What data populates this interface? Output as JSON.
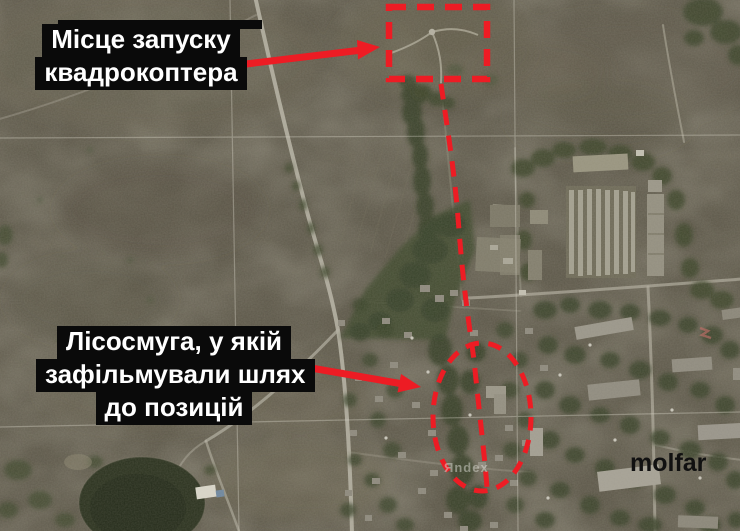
{
  "canvas": {
    "width": 740,
    "height": 531
  },
  "labels": {
    "launch": {
      "line1": "Місце запуску",
      "line2": "квадрокоптера"
    },
    "forest": {
      "line1": "Лісосмуга, у якій",
      "line2": "зафільмували шлях",
      "line3": "до позицій"
    }
  },
  "watermarks": {
    "brand": "molfar",
    "map_provider": "Яndex"
  },
  "style": {
    "annotation_red": "#ed1c24",
    "label_background": "#0a0a0a",
    "label_text_color": "#ffffff",
    "map_base_color": "#5e594b"
  }
}
